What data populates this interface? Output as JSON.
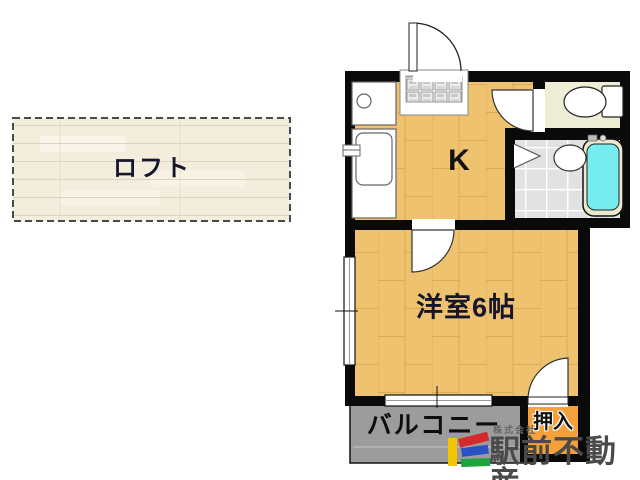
{
  "floor_plan": {
    "loft": {
      "label": "ロフト"
    },
    "kitchen": {
      "label": "K"
    },
    "western_room": {
      "label": "洋室6帖"
    },
    "balcony": {
      "label": "バルコニー"
    },
    "closet": {
      "label": "押入"
    }
  },
  "branding": {
    "company_prefix": "株式会社",
    "company_name": "駅前不動産"
  },
  "colors": {
    "wall": "#0a0a0a",
    "wood_floor": "#eec26e",
    "loft_floor": "#f3eddd",
    "toilet_floor": "#eeeed6",
    "tile_floor": "#e2e2e2",
    "bathtub": "#76ecef",
    "tub_rim": "#ece8ce",
    "closet_fill": "#f6a03b",
    "balcony_fill": "#9c9c9c",
    "logo_yellow": "#f2c500",
    "logo_red": "#d42a2e",
    "logo_blue": "#2b52c4",
    "logo_green": "#1ea33e"
  }
}
